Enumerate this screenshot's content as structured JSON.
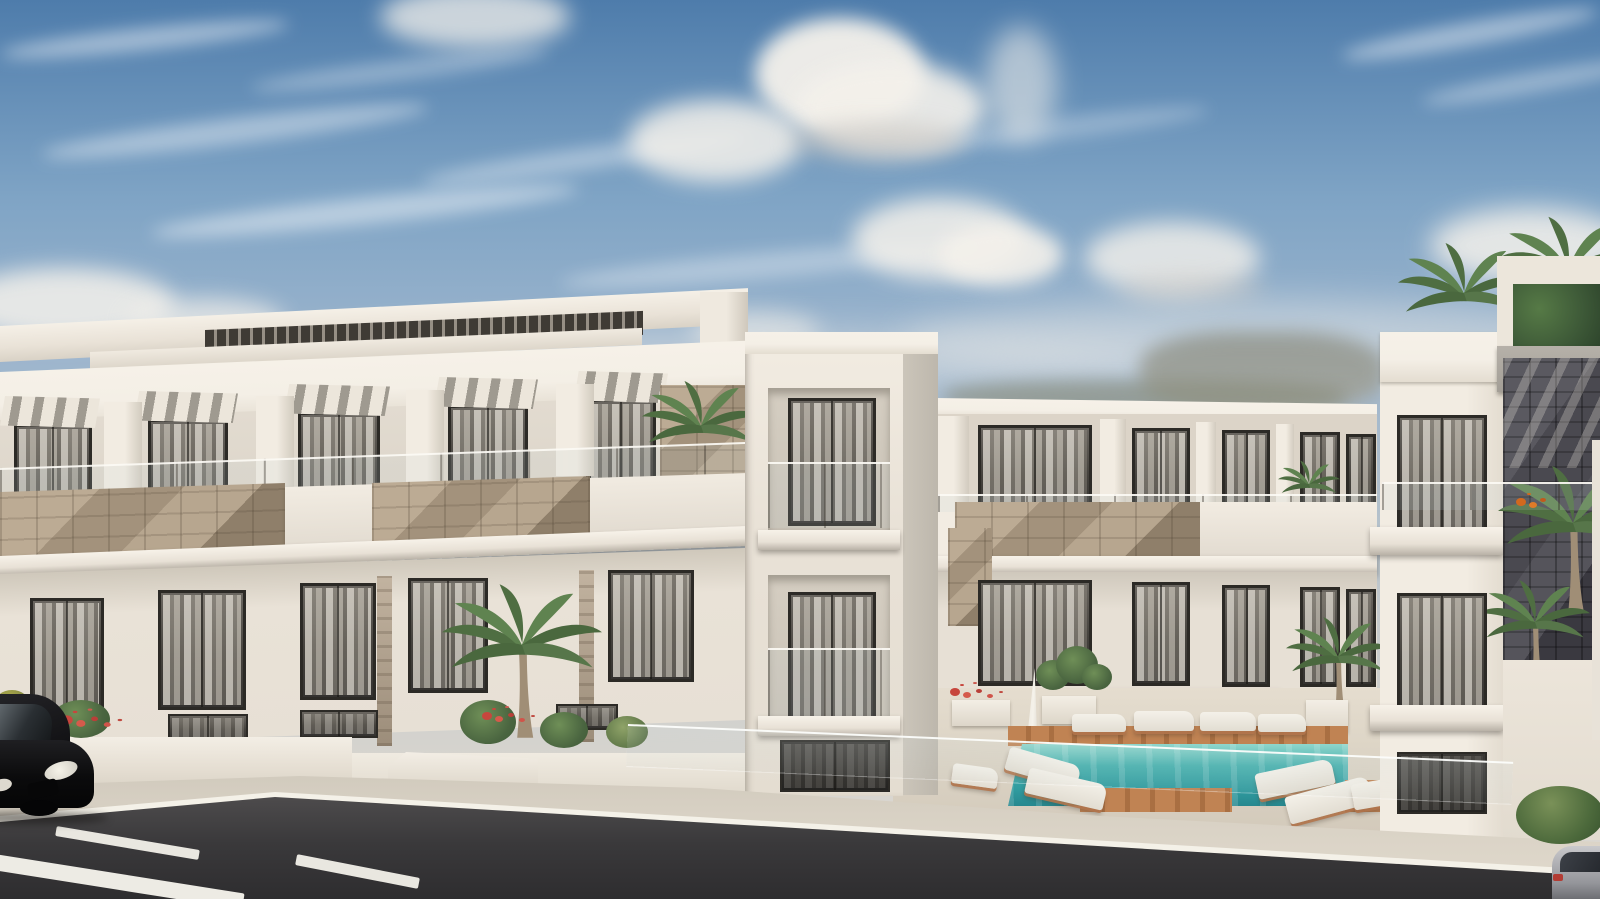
{
  "meta": {
    "type": "architectural-exterior-render",
    "width_px": 1600,
    "height_px": 899,
    "description": "Sunny photorealistic rendering of a modern white low-rise apartment complex: left block with rooftop pergola and striped awnings, center 3-storey block behind a turquoise pool with wooden deck and sun loungers, right balcony tower with dark stone feature wall and palm trees, asphalt street with white lane markings, black car at lower left, partial gray car at lower right"
  },
  "palette": {
    "sky-top": "#4e7cab",
    "sky-mid": "#7fa4c5",
    "sky-low": "#b4c1cb",
    "sky-horizon": "#d8d5cf",
    "cloud": "#f4f1eb",
    "wall-sun": "#efe9df",
    "wall-light": "#e7e0d5",
    "wall-shade": "#d8d1c6",
    "wall-dark": "#c6c0b6",
    "wall-deep": "#a9a399",
    "fascia": "#f4efe6",
    "frame": "#2c2a26",
    "glass-dark": "#46433f",
    "curtain": "#d9d3c8",
    "awning-light": "#ece6db",
    "awning-dark": "#9f9a90",
    "stone-light": "#bcab94",
    "stone-dark": "#8f7f6a",
    "darkstone-light": "#5a5960",
    "darkstone-dark": "#3a3940",
    "pool-light": "#8fd6cc",
    "pool-deep": "#27888f",
    "wood-light": "#c08353",
    "wood-dark": "#a96f42",
    "deck": "#dcd4c5",
    "sidewalk": "#d8d1c4",
    "curb": "#f4f1e8",
    "road-light": "#4e4c4d",
    "road-dark": "#2e2d2f",
    "green-light": "#6f8f57",
    "green-dark": "#3f5c36",
    "flower-red": "#c7463d",
    "palm-green": "#4f6e42",
    "palm-green2": "#5f8350",
    "trunk": "#a08e76"
  },
  "sky": {
    "cloud_blobs": 13,
    "wisp_streaks": 9,
    "haze_bands": 2
  },
  "left_building": {
    "rooftop_pergola": true,
    "pergola_slats": true,
    "awnings": 5,
    "upper_windows": 5,
    "lower_windows": 5,
    "ground_windows": 3,
    "stone_balustrade_sections": 2,
    "marble_strips": 2,
    "palm_trees": 2,
    "flower_planters": 1
  },
  "left_tower": {
    "balconies": 2,
    "ground_window": 1
  },
  "background_building": {
    "floors": 3,
    "upper_windows": 5,
    "mid_windows": 5,
    "entrance_doors": 1,
    "entrance_canopy_slats": true,
    "balcony_plants": 1,
    "stone_parapet": true
  },
  "pool_area": {
    "pool": true,
    "wooden_deck": true,
    "loungers": 10,
    "umbrellas": 1,
    "planters": 3,
    "potted_palm": 1,
    "glass_fence": true
  },
  "right_building": {
    "balcony_windows": 2,
    "ground_window": 1,
    "rooftop_garden_box": true,
    "dark_stone_wall": true,
    "palm_trees": 4,
    "flower_accent": 1,
    "bush": 1
  },
  "street": {
    "lane_dashes": 3,
    "curb_line": true,
    "vehicles": [
      {
        "name": "black-car",
        "position": "bottom-left"
      },
      {
        "name": "gray-car",
        "position": "bottom-right"
      }
    ]
  }
}
